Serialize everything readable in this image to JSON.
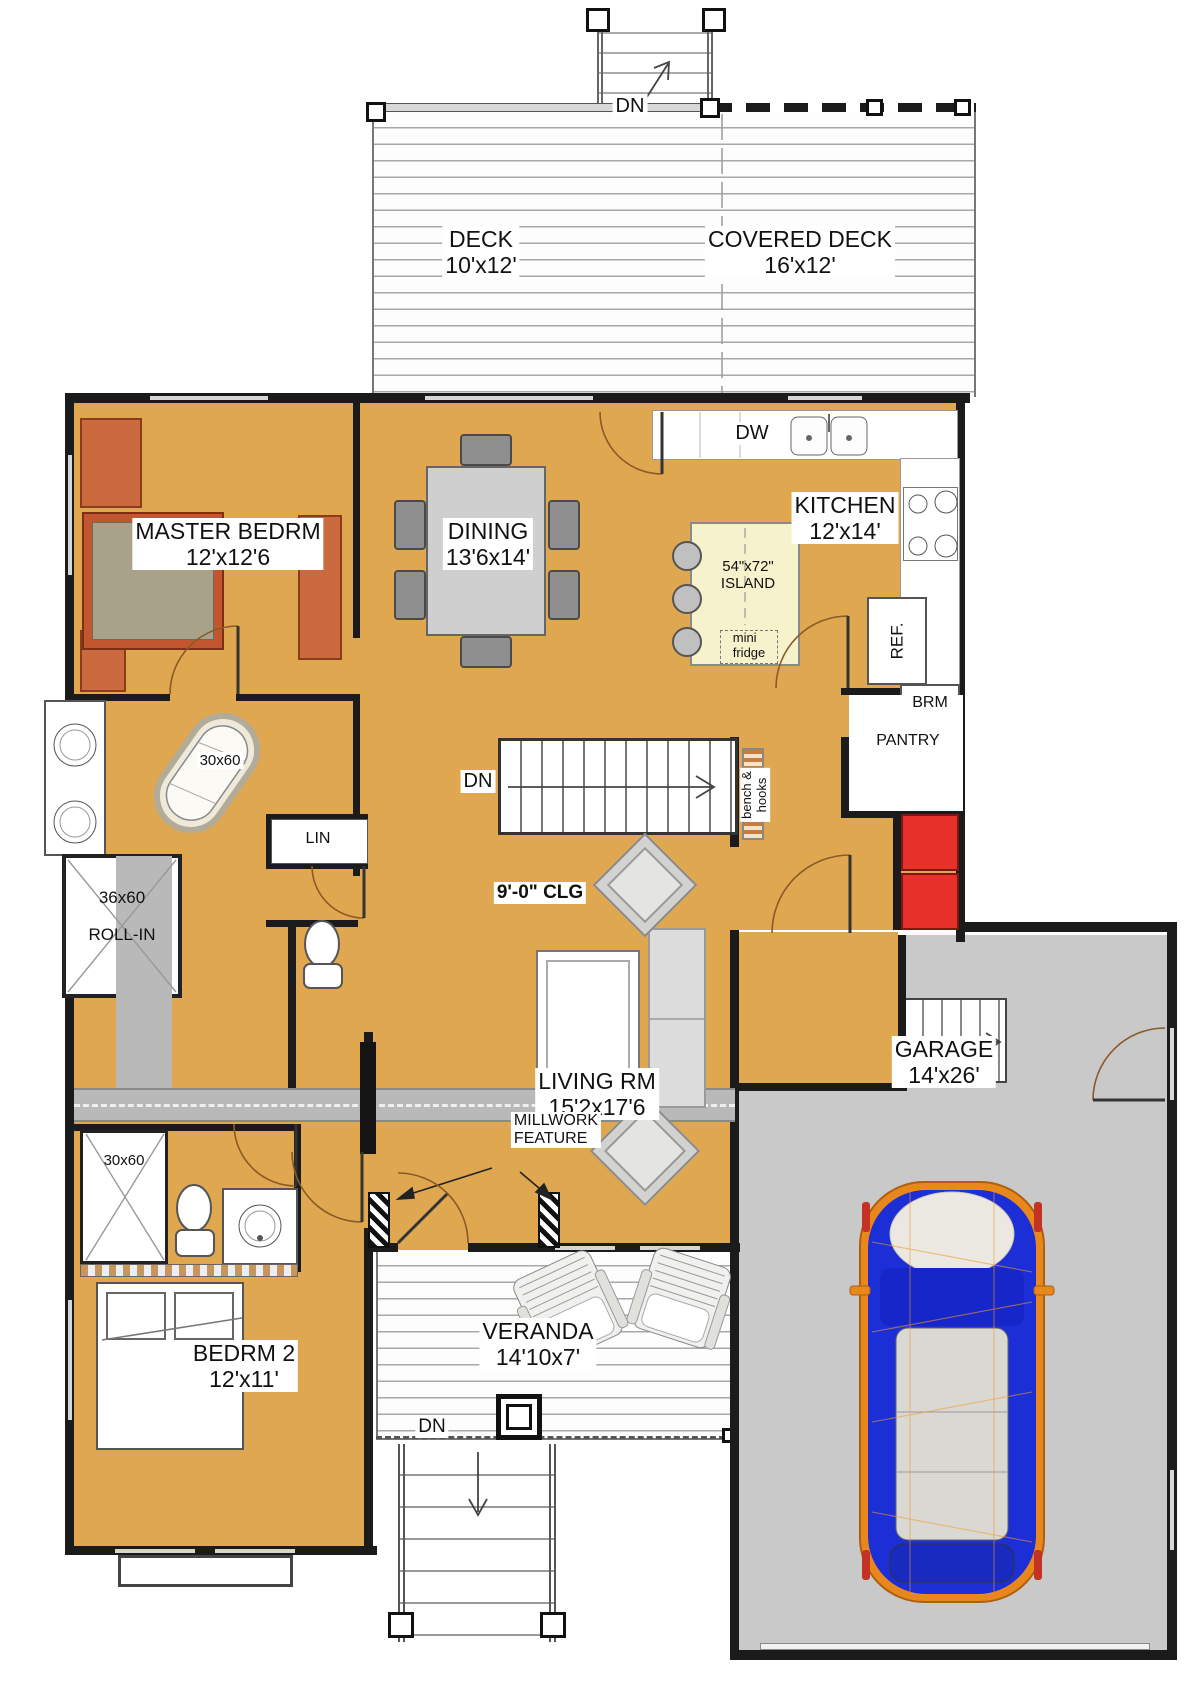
{
  "colors": {
    "floor": "#dfa850",
    "garage_floor": "#c9c9c9",
    "wall": "#1b1b1b",
    "island": "#f6f2cb",
    "accent_red": "#e8302a",
    "furniture_orange": "#cb6a3e",
    "bed_blanket": "#a9a28b",
    "car_body": "#1c2fd6",
    "car_frame": "#e8871c",
    "door_arc": "#8a5a28"
  },
  "rooms": {
    "deck": {
      "name": "DECK",
      "dims": "10'x12'"
    },
    "covered_deck": {
      "name": "COVERED DECK",
      "dims": "16'x12'"
    },
    "master_bedroom": {
      "name": "MASTER BEDRM",
      "dims": "12'x12'6"
    },
    "dining": {
      "name": "DINING",
      "dims": "13'6x14'"
    },
    "kitchen": {
      "name": "KITCHEN",
      "dims": "12'x14'"
    },
    "living_room": {
      "name": "LIVING RM",
      "dims": "15'2x17'6"
    },
    "bedroom2": {
      "name": "BEDRM 2",
      "dims": "12'x11'"
    },
    "veranda": {
      "name": "VERANDA",
      "dims": "14'10x7'"
    },
    "garage": {
      "name": "GARAGE",
      "dims": "14'x26'"
    },
    "pantry": {
      "name": "PANTRY"
    },
    "linen_closet": {
      "name": "LIN"
    }
  },
  "fixtures": {
    "dishwasher": "DW",
    "island": {
      "size": "54\"x72\"",
      "name": "ISLAND"
    },
    "mini_fridge": {
      "line1": "mini",
      "line2": "fridge"
    },
    "refrigerator": "REF.",
    "broom_closet": "BRM",
    "bench_hooks": {
      "line1": "bench &",
      "line2": "hooks"
    },
    "master_tub": "30x60",
    "rollin_shower": {
      "size": "36x60",
      "name": "ROLL-IN"
    },
    "bath2_shower": "30x60",
    "ceiling_height": "9'-0\" CLG",
    "millwork": {
      "line1": "MILLWORK",
      "line2": "FEATURE"
    }
  },
  "stairs": {
    "deck_down": "DN",
    "basement_down": "DN",
    "veranda_down": "DN"
  }
}
